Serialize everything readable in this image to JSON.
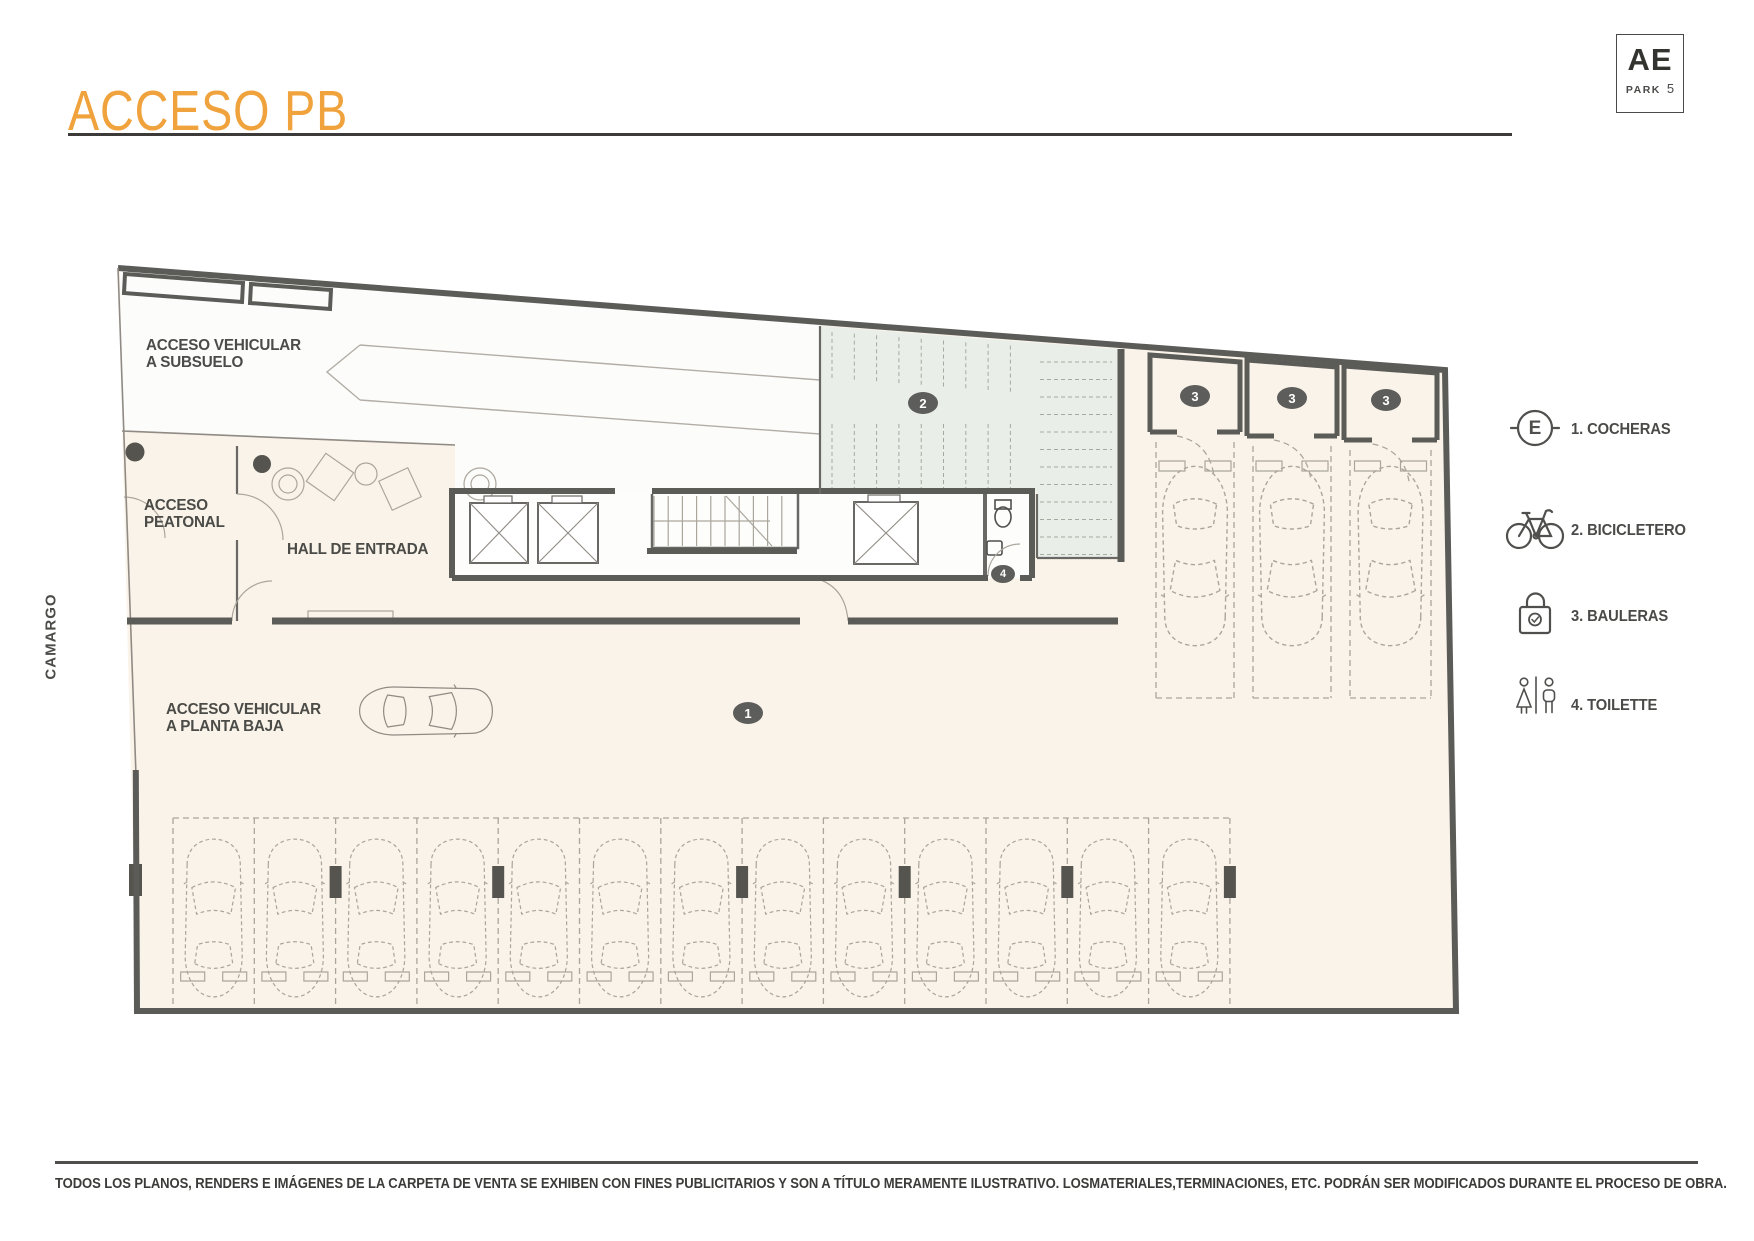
{
  "header": {
    "title": "ACCESO PB"
  },
  "logo": {
    "brand": "AE",
    "sub": "PARK",
    "number": "5"
  },
  "plan": {
    "street": "CAMARGO",
    "labels": {
      "ramp": "ACCESO VEHICULAR\nA SUBSUELO",
      "pedestrian": "ACCESO\nPEATONAL",
      "hall": "HALL DE ENTRADA",
      "driveway": "ACCESO VEHICULAR\nA PLANTA BAJA"
    },
    "badges": {
      "cocheras": "1",
      "bicicletero": "2",
      "bauleras": "3",
      "toilette": "4"
    }
  },
  "legend": {
    "items": [
      {
        "icon": "elevator-e-icon",
        "symbol": "E",
        "label": "1. COCHERAS"
      },
      {
        "icon": "bicycle-icon",
        "label": "2. BICICLETERO"
      },
      {
        "icon": "padlock-icon",
        "label": "3. BAULERAS"
      },
      {
        "icon": "toilette-icon",
        "label": "4. TOILETTE"
      }
    ]
  },
  "footer": {
    "disclaimer": "TODOS LOS PLANOS, RENDERS E IMÁGENES DE LA CARPETA DE VENTA SE EXHIBEN CON FINES PUBLICITARIOS Y SON A TÍTULO MERAMENTE ILUSTRATIVO. LOSMATERIALES,TERMINACIONES, ETC. PODRÁN SER MODIFICADOS DURANTE EL PROCESO DE OBRA."
  }
}
